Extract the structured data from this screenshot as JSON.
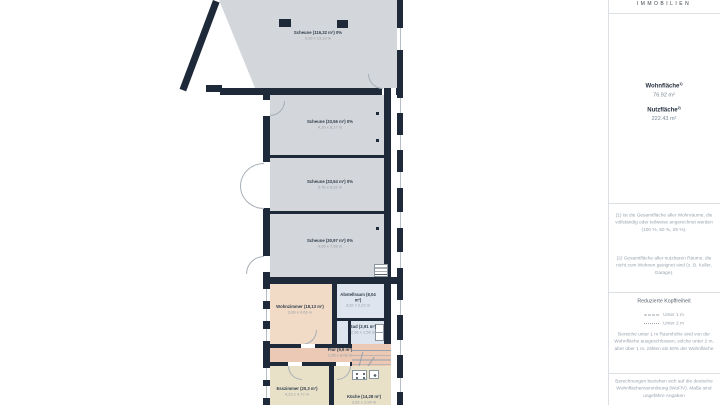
{
  "brand": {
    "logo_text": "IMMOBILIEN"
  },
  "sidebar": {
    "areas": {
      "wohnflaeche_label": "Wohnfläche",
      "wohnflaeche_sup": "1)",
      "wohnflaeche_value": "76.92 m²",
      "nutzflaeche_label": "Nutzfläche",
      "nutzflaeche_sup": "2)",
      "nutzflaeche_value": "222.43 m²"
    },
    "footnotes": {
      "note1": "(1) Ist die Gesamtfläche aller Wohnräume, die vollständig oder teilweise angerechnet werden (100 %, 50 %, 25 %).",
      "note2": "(2) Gesamtfläche aller nutzbaren Räume, die nicht zum Wohnen geeignet sind (z. B. Keller, Garage)."
    },
    "headroom": {
      "title": "Reduzierte Kopffreiheit",
      "legend": [
        {
          "style": "dashed",
          "label": "Unter 1 m"
        },
        {
          "style": "dotted",
          "label": "Unter 2 m"
        }
      ],
      "text": "Bereiche unter 1 m Raumhöhe sind von der Wohnfläche ausgeschlossen; solche unter 2 m, aber über 1 m, zählen als 50% der Wohnfläche"
    },
    "disclaimer": "Berechnungen beziehen sich auf die deutsche Wohnflächenverordnung (WoFlV). Maße sind ungefähre Angaben"
  },
  "floorplan": {
    "rooms": [
      {
        "id": "scheune-1",
        "name": "Scheune (116,32 m²) 0%",
        "dims": "9,06 x 13,13 m"
      },
      {
        "id": "scheune-2",
        "name": "Scheune (33,56 m²) 0%",
        "dims": "4,10 x 8,17 m"
      },
      {
        "id": "scheune-3",
        "name": "Scheune (33,54 m²) 0%",
        "dims": "3,76 x 9,02 m"
      },
      {
        "id": "scheune-4",
        "name": "Scheune (30,97 m²) 0%",
        "dims": "4,09 x 7,58 m"
      },
      {
        "id": "wohnzimmer",
        "name": "Wohnzimmer (18,13 m²)",
        "dims": "3,89 x 4,66 m"
      },
      {
        "id": "abstellraum",
        "name": "Abstellraum (8,04 m²)",
        "dims": "3,62 x 2,22 m"
      },
      {
        "id": "bad",
        "name": "Bad (3,91 m²)",
        "dims": "2,56 x 1,56 m"
      },
      {
        "id": "flur",
        "name": "Flur (9,9 m²)",
        "dims": "1,05 x 8,06 m"
      },
      {
        "id": "esszimmer",
        "name": "Esszimmer (20,3 m²)",
        "dims": "4,23 x 4,72 m"
      },
      {
        "id": "kueche",
        "name": "Küche (14,28 m²)",
        "dims": "3,62 x 3,94 m"
      }
    ],
    "colors": {
      "wall": "#1e2a39",
      "nutzflaeche_fill": "#d3d6da",
      "living_fill": "#f2dbc6",
      "utility_fill": "#dfe5ee",
      "hall_fill": "#ebc9b5",
      "kitchen_fill": "#e9e1c7",
      "panel_line": "#dcdfe3"
    }
  }
}
